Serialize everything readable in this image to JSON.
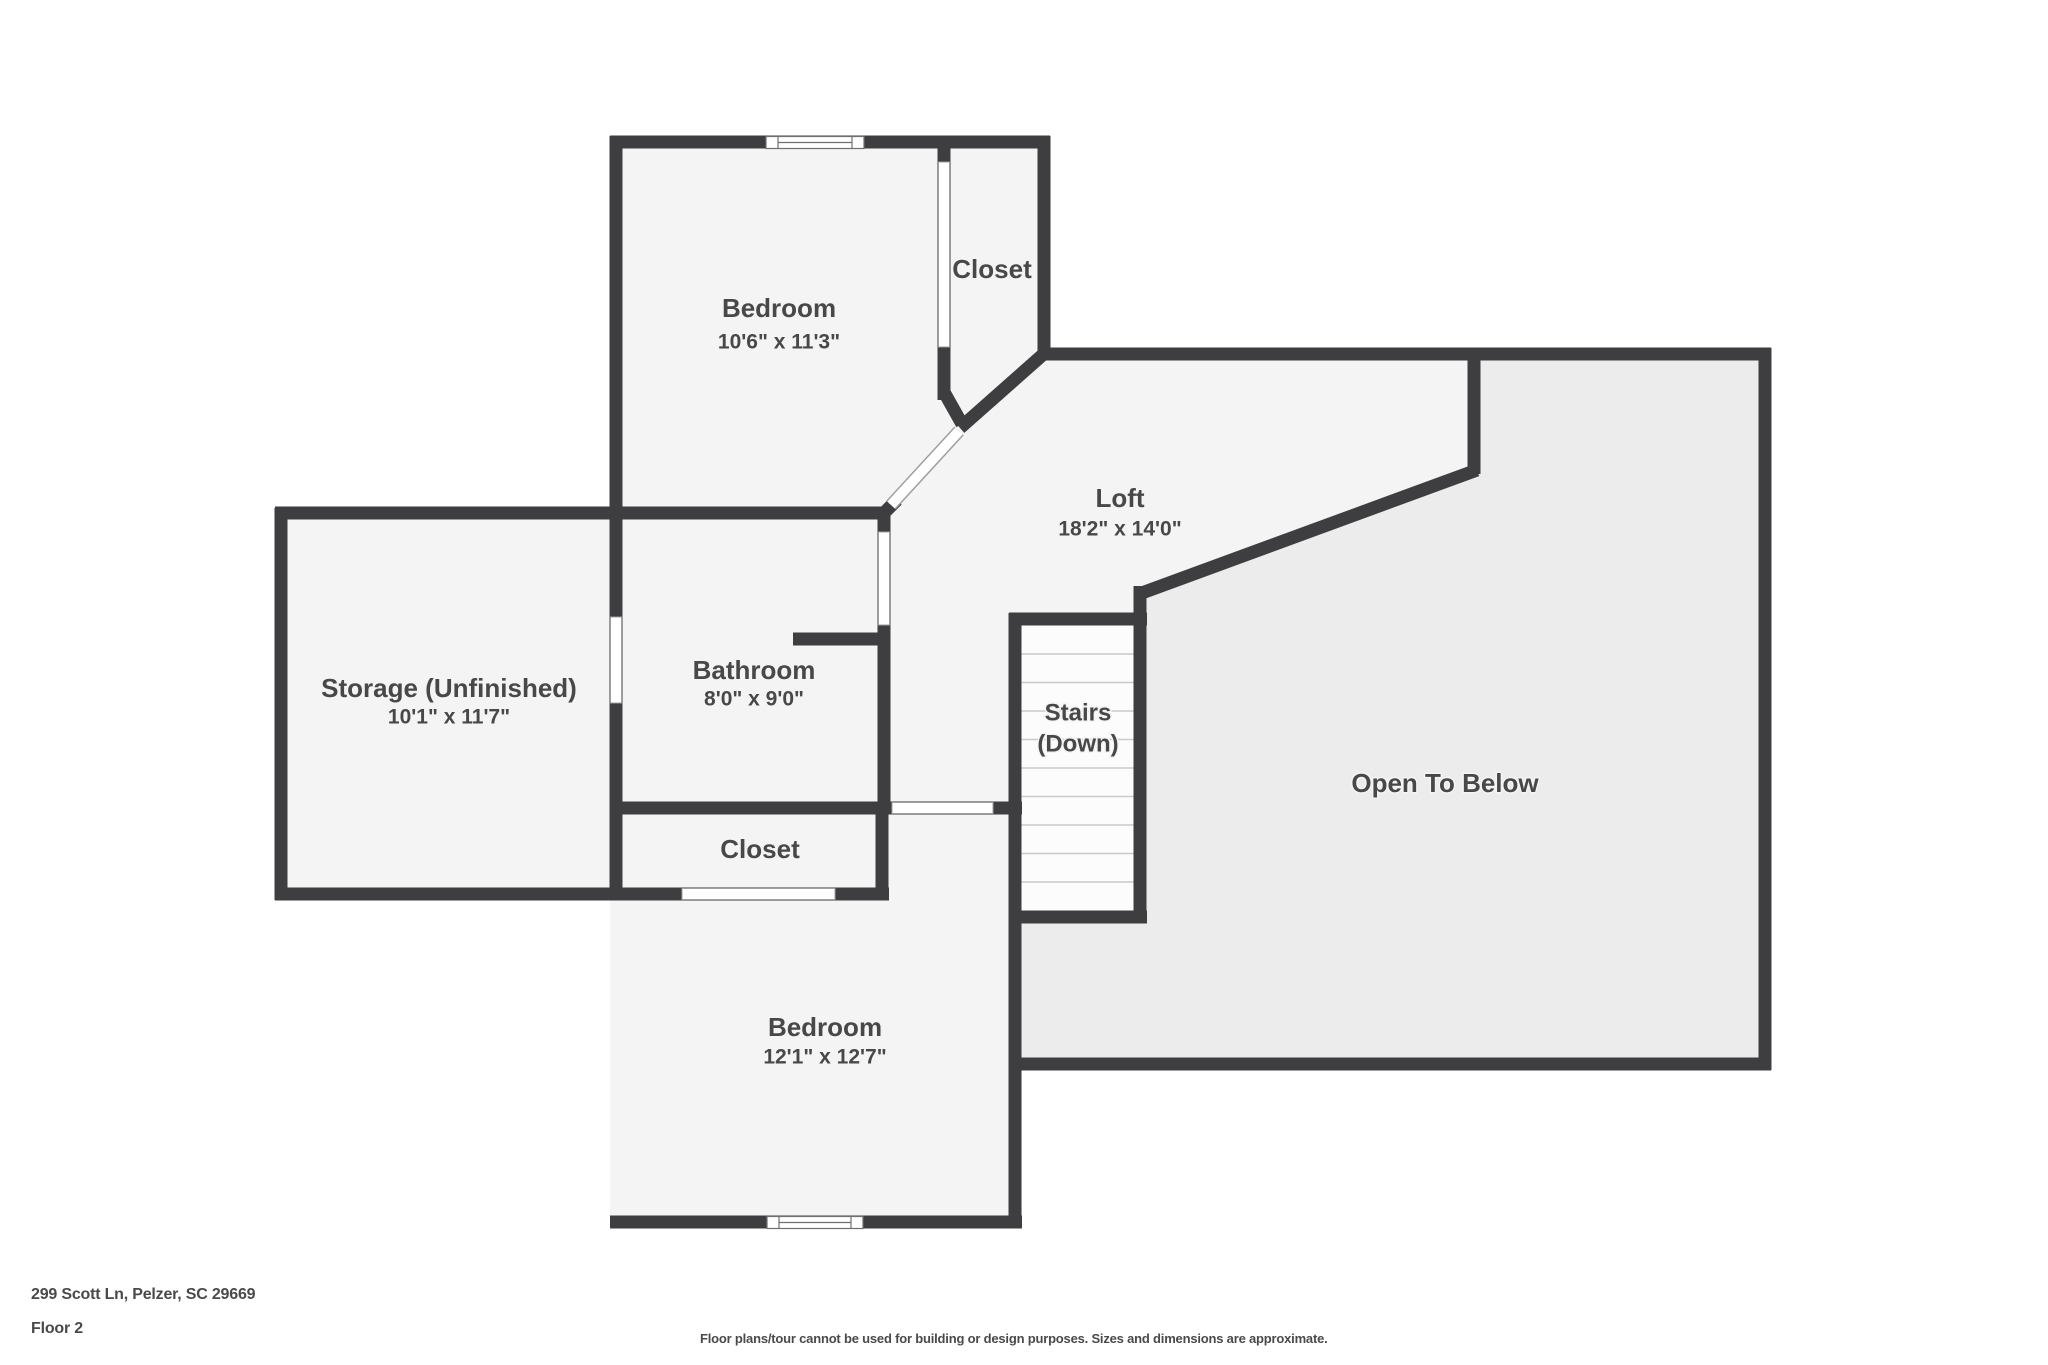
{
  "meta": {
    "address": "299 Scott Ln, Pelzer, SC 29669",
    "floor_label": "Floor 2",
    "disclaimer": "Floor plans/tour cannot be used for building or design purposes. Sizes and dimensions are approximate."
  },
  "colors": {
    "background": "#ffffff",
    "wall": "#3e3e40",
    "floor": "#f4f4f4",
    "open_area": "#ececec",
    "stairs_fill": "#fcfcfc",
    "tread_line": "#c9c9c9",
    "opening_fill": "#ffffff",
    "opening_outline": "#9e9e9e",
    "window_outline": "#6f6f6f",
    "label": "#484848"
  },
  "rooms": [
    {
      "id": "bedroom-top",
      "label": "Bedroom",
      "sub": "10'6\" x 11'3\"",
      "x": 779,
      "label_y": 310,
      "sub_y": 343,
      "label_size": 26,
      "sub_size": 21
    },
    {
      "id": "closet-top",
      "label": "Closet",
      "sub": null,
      "x": 992,
      "label_y": 271,
      "sub_y": null,
      "label_size": 26,
      "sub_size": 21
    },
    {
      "id": "loft",
      "label": "Loft",
      "sub": "18'2\" x 14'0\"",
      "x": 1120,
      "label_y": 500,
      "sub_y": 530,
      "label_size": 26,
      "sub_size": 21
    },
    {
      "id": "storage",
      "label": "Storage (Unfinished)",
      "sub": "10'1\" x 11'7\"",
      "x": 449,
      "label_y": 690,
      "sub_y": 718,
      "label_size": 26,
      "sub_size": 21
    },
    {
      "id": "bathroom",
      "label": "Bathroom",
      "sub": "8'0\" x 9'0\"",
      "x": 754,
      "label_y": 672,
      "sub_y": 700,
      "label_size": 26,
      "sub_size": 21
    },
    {
      "id": "stairs",
      "label": "Stairs",
      "sub": "(Down)",
      "x": 1078,
      "label_y": 714,
      "sub_y": 745,
      "label_size": 24,
      "sub_size": 24
    },
    {
      "id": "closet-bottom",
      "label": "Closet",
      "sub": null,
      "x": 760,
      "label_y": 851,
      "sub_y": null,
      "label_size": 26,
      "sub_size": 21
    },
    {
      "id": "open-to-below",
      "label": "Open To Below",
      "sub": null,
      "x": 1445,
      "label_y": 785,
      "sub_y": null,
      "label_size": 26,
      "sub_size": 21
    },
    {
      "id": "bedroom-bottom",
      "label": "Bedroom",
      "sub": "12'1\" x 12'7\"",
      "x": 825,
      "label_y": 1029,
      "sub_y": 1058,
      "label_size": 26,
      "sub_size": 21
    }
  ],
  "geometry": {
    "canvas": {
      "width": 2048,
      "height": 1365
    },
    "wall_thickness": 13,
    "floor_polygon": [
      [
        610,
        136
      ],
      [
        1050,
        136
      ],
      [
        1050,
        348
      ],
      [
        1771,
        348
      ],
      [
        1771,
        1070
      ],
      [
        1022,
        1070
      ],
      [
        1022,
        1228
      ],
      [
        610,
        1228
      ],
      [
        610,
        900
      ],
      [
        275,
        900
      ],
      [
        275,
        508
      ],
      [
        610,
        508
      ]
    ],
    "open_below_polygon": [
      [
        1475,
        355
      ],
      [
        1765,
        355
      ],
      [
        1765,
        1064
      ],
      [
        1016,
        1064
      ],
      [
        1016,
        920
      ],
      [
        1141,
        920
      ],
      [
        1141,
        593
      ],
      [
        1475,
        473
      ]
    ],
    "stairs_box": {
      "x": 1021,
      "y": 625,
      "w": 113,
      "h": 286
    },
    "treads": {
      "x1": 1021,
      "x2": 1134,
      "y_start": 654,
      "step": 28.5,
      "count": 9
    },
    "walls": [
      {
        "id": "bedroom-top-north",
        "x1": 610,
        "y1": 142,
        "x2": 1050,
        "y2": 142
      },
      {
        "id": "west-wall",
        "x1": 616,
        "y1": 136,
        "x2": 616,
        "y2": 900
      },
      {
        "id": "storage-bathroom-north",
        "x1": 275,
        "y1": 513,
        "x2": 890,
        "y2": 513
      },
      {
        "id": "storage-west",
        "x1": 281,
        "y1": 508,
        "x2": 281,
        "y2": 900
      },
      {
        "id": "storage-closet-south",
        "x1": 275,
        "y1": 894,
        "x2": 889,
        "y2": 894
      },
      {
        "id": "bedroom-closet-divider",
        "x1": 944,
        "y1": 136,
        "x2": 944,
        "y2": 400
      },
      {
        "id": "closet-top-east",
        "x1": 1044,
        "y1": 136,
        "x2": 1044,
        "y2": 360
      },
      {
        "id": "loft-otb-north",
        "x1": 1038,
        "y1": 354,
        "x2": 1771,
        "y2": 354
      },
      {
        "id": "bathroom-east",
        "x1": 884,
        "y1": 507,
        "x2": 884,
        "y2": 814
      },
      {
        "id": "bathroom-interior-stub",
        "x1": 793,
        "y1": 639,
        "x2": 890,
        "y2": 639
      },
      {
        "id": "hall-bedroom-wall",
        "x1": 610,
        "y1": 808,
        "x2": 1022,
        "y2": 808
      },
      {
        "id": "closet-bottom-east",
        "x1": 882,
        "y1": 802,
        "x2": 882,
        "y2": 900
      },
      {
        "id": "stairs-west-bedroom-east",
        "x1": 1015,
        "y1": 613,
        "x2": 1015,
        "y2": 1228
      },
      {
        "id": "stairs-north",
        "x1": 1009,
        "y1": 619,
        "x2": 1147,
        "y2": 619
      },
      {
        "id": "stairs-south",
        "x1": 1009,
        "y1": 917,
        "x2": 1147,
        "y2": 917
      },
      {
        "id": "stairs-east",
        "x1": 1140,
        "y1": 586,
        "x2": 1140,
        "y2": 923
      },
      {
        "id": "loft-otb-step",
        "x1": 1474,
        "y1": 348,
        "x2": 1474,
        "y2": 474
      },
      {
        "id": "otb-east",
        "x1": 1765,
        "y1": 348,
        "x2": 1765,
        "y2": 1070
      },
      {
        "id": "otb-south",
        "x1": 1016,
        "y1": 1064,
        "x2": 1771,
        "y2": 1064
      },
      {
        "id": "bedroom-bottom-south",
        "x1": 610,
        "y1": 1222,
        "x2": 1022,
        "y2": 1222
      },
      {
        "id": "closet-diagonal",
        "x1": 1047,
        "y1": 351,
        "x2": 960,
        "y2": 428
      },
      {
        "id": "divider-diagonal-tip",
        "x1": 944,
        "y1": 392,
        "x2": 962,
        "y2": 424
      },
      {
        "id": "bathroom-corner-tip",
        "x1": 884,
        "y1": 513,
        "x2": 897,
        "y2": 500
      },
      {
        "id": "loft-otb-diagonal",
        "x1": 1477,
        "y1": 470,
        "x2": 1139,
        "y2": 594
      }
    ],
    "openings": [
      {
        "id": "closet-top-door",
        "x": 938.5,
        "y": 162,
        "w": 11,
        "h": 185
      },
      {
        "id": "storage-pass-through",
        "x": 610.5,
        "y": 617,
        "w": 11,
        "h": 86
      },
      {
        "id": "bathroom-door",
        "x": 878.5,
        "y": 532,
        "w": 11,
        "h": 93
      },
      {
        "id": "bedroom-bottom-door",
        "x": 892,
        "y": 802.5,
        "w": 101,
        "h": 11
      },
      {
        "id": "closet-bottom-door",
        "x": 682,
        "y": 888.5,
        "w": 153,
        "h": 11
      }
    ],
    "diagonal_door": {
      "id": "bedroom-top-door",
      "x1": 959,
      "y1": 431,
      "x2": 891,
      "y2": 505,
      "outer_w": 13,
      "inner_w": 10
    },
    "windows": [
      {
        "id": "bedroom-top-window",
        "x": 766,
        "y": 136.5,
        "w": 98,
        "h": 12,
        "cap": 12
      },
      {
        "id": "bedroom-bottom-window",
        "x": 767,
        "y": 1216.5,
        "w": 96,
        "h": 12,
        "cap": 12
      }
    ]
  }
}
